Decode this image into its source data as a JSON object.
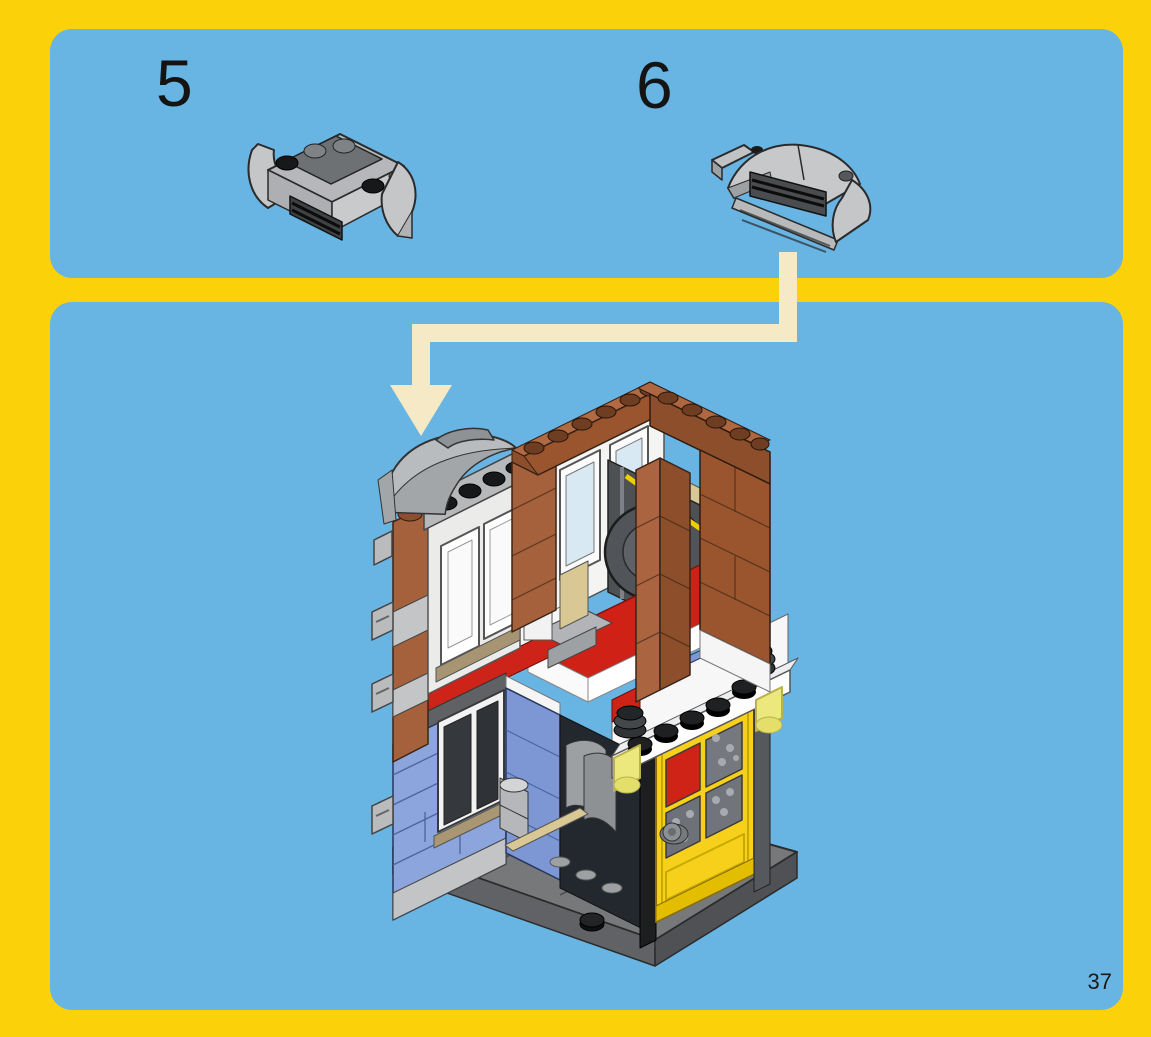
{
  "page": {
    "type": "lego-building-instructions",
    "number": "37",
    "colors": {
      "background_yellow": "#FBD109",
      "panel_blue": "#68B4E3",
      "arrow_cream": "#F6E9C6",
      "brick_brown": "#A5613B",
      "wall_blue": "#8CA5DC",
      "door_yellow": "#F6D01A",
      "accent_red": "#CE2318",
      "piece_gray": "#C6C8CA",
      "base_gray": "#77787A"
    }
  },
  "steps": [
    {
      "label": "5",
      "piece": "gray-curved-grille-awning-subassembly, studs up"
    },
    {
      "label": "6",
      "piece": "gray-curved-grille-awning-subassembly, curved top view"
    }
  ],
  "main_panel": {
    "illustration": "isometric-lego-corner-building: brown upper walls with stud parapet, gray awning on roof, interior fan unit with yellow trim, red floor plates, blue ground-floor walls, yellow four-pane door with white studded lintel, trans-yellow lamps, dark gray base plates",
    "arrow": "cream placement arrow from step-6 piece down-left to awning position on model roof"
  }
}
